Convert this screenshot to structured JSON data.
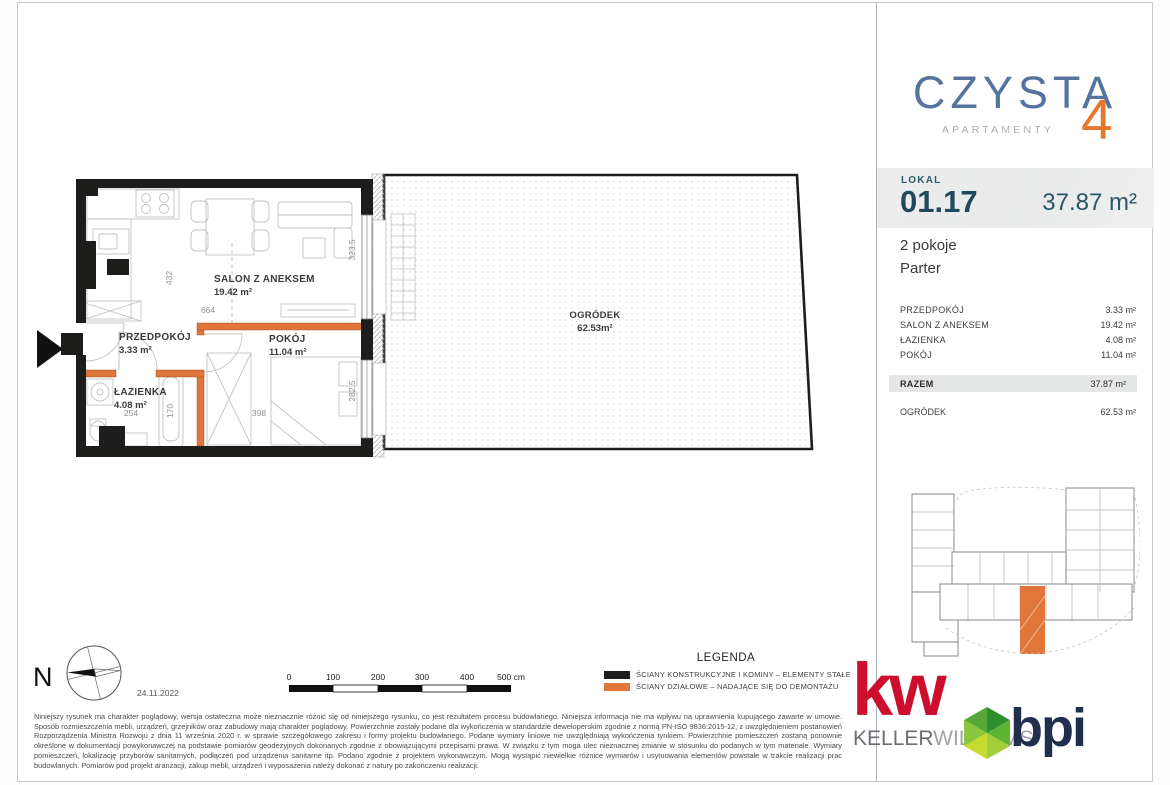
{
  "brand": {
    "name": "CZYSTA",
    "number": "4",
    "subtitle": "APARTAMENTY"
  },
  "unit": {
    "label": "LOKAL",
    "number": "01.17",
    "total_area": "37.87 m²",
    "rooms_count": "2 pokoje",
    "floor": "Parter"
  },
  "room_table": {
    "rows": [
      {
        "label": "PRZEDPOKÓJ",
        "value": "3.33 m²"
      },
      {
        "label": "SALON Z ANEKSEM",
        "value": "19.42 m²"
      },
      {
        "label": "ŁAZIENKA",
        "value": "4.08 m²"
      },
      {
        "label": "POKÓJ",
        "value": "11.04 m²"
      }
    ],
    "total": {
      "label": "RAZEM",
      "value": "37.87 m²"
    },
    "extra": {
      "label": "OGRÓDEK",
      "value": "62.53 m²"
    }
  },
  "floor_plan": {
    "rooms": [
      {
        "name": "SALON Z ANEKSEM",
        "area": "19.42 m²"
      },
      {
        "name": "PRZEDPOKÓJ",
        "area": "3.33 m²"
      },
      {
        "name": "POKÓJ",
        "area": "11.04 m²"
      },
      {
        "name": "ŁAZIENKA",
        "area": "4.08 m²"
      }
    ],
    "garden": {
      "name": "OGRÓDEK",
      "area": "62.53m²"
    },
    "dimensions_cm": {
      "salon_height": "432",
      "salon_width": "664",
      "bath_width": "254",
      "bath_height": "170",
      "room_width": "398",
      "salon_window": "323.5",
      "room_window": "282.5"
    }
  },
  "compass": {
    "north": "N",
    "date": "24.11.2022"
  },
  "scale_bar": {
    "ticks": [
      "0",
      "100",
      "200",
      "300",
      "400"
    ],
    "end_label": "500 cm"
  },
  "legend": {
    "title": "LEGENDA",
    "items": [
      {
        "color": "#1d1d1b",
        "label": "ŚCIANY KONSTRUKCYJNE I KOMINY – ELEMENTY STAŁE"
      },
      {
        "color": "#e0763a",
        "label": "ŚCIANY DZIAŁOWE – NADAJĄCE SIĘ DO DEMONTAŻU"
      }
    ]
  },
  "disclaimer": "Niniejszy rysunek ma charakter poglądowy, wersja ostateczna może nieznacznie różnić się od niniejszego rysunku, co jest rezultatem procesu budowlanego. Niniejsza informacja nie ma wpływu na uprawnienia kupującego zawarte w umowie. Sposób rozmieszczenia mebli, urządzeń, grzejników oraz zabudowy mają charakter poglądowy. Powierzchnie zostały podane dla wykończenia w standardzie deweloperskim zgodnie z normą PN-ISO 9836:2015-12, z uwzględnieniem postanowień Rozporządzenia Ministra Rozwoju z dnia 11 września 2020 r. w sprawie szczegółowego zakresu i formy projektu budowlanego. Podane wymiary liniowe nie uwzględniają wykończenia tynkiem. Powierzchnie pomieszczeń zostaną ponownie określone w dokumentacji powykonawczej na podstawie pomiarów geodezyjnych dokonanych zgodnie z obowiązującymi przepisami prawa. W związku z tym moga ulec nieznacznej zmianie w stosunku do podanych w tym materiale. Wymiary pomieszczeń, lokalizację przyborów sanitarnych, podłączeń pod urządzenia sanitarne itp. Podano zgodnie z projektem wykonawczym. Mogą wystąpić niewielkie różnice wymiarów i usytuowania elementów powstałe w trakcie realizacji prac budowlanych. Pomiarów pod projekt aranżacji, zakup mebli, urządzeń i wyposażenia należy dokonać z natury po zakończeniu realizacji.",
  "logos": {
    "kw": {
      "mark": "kw",
      "name_primary": "KELLER",
      "name_secondary": "WILLIAMS"
    },
    "bpi": {
      "name": "bpi"
    }
  },
  "colors": {
    "wall_black": "#1d1d1b",
    "partition_orange": "#e0763a",
    "brand_blue": "#54749f",
    "brand_orange": "#e8772e",
    "teal_dark": "#1f4a5e",
    "kw_red": "#ce0e2d",
    "bpi_navy": "#20304c"
  }
}
